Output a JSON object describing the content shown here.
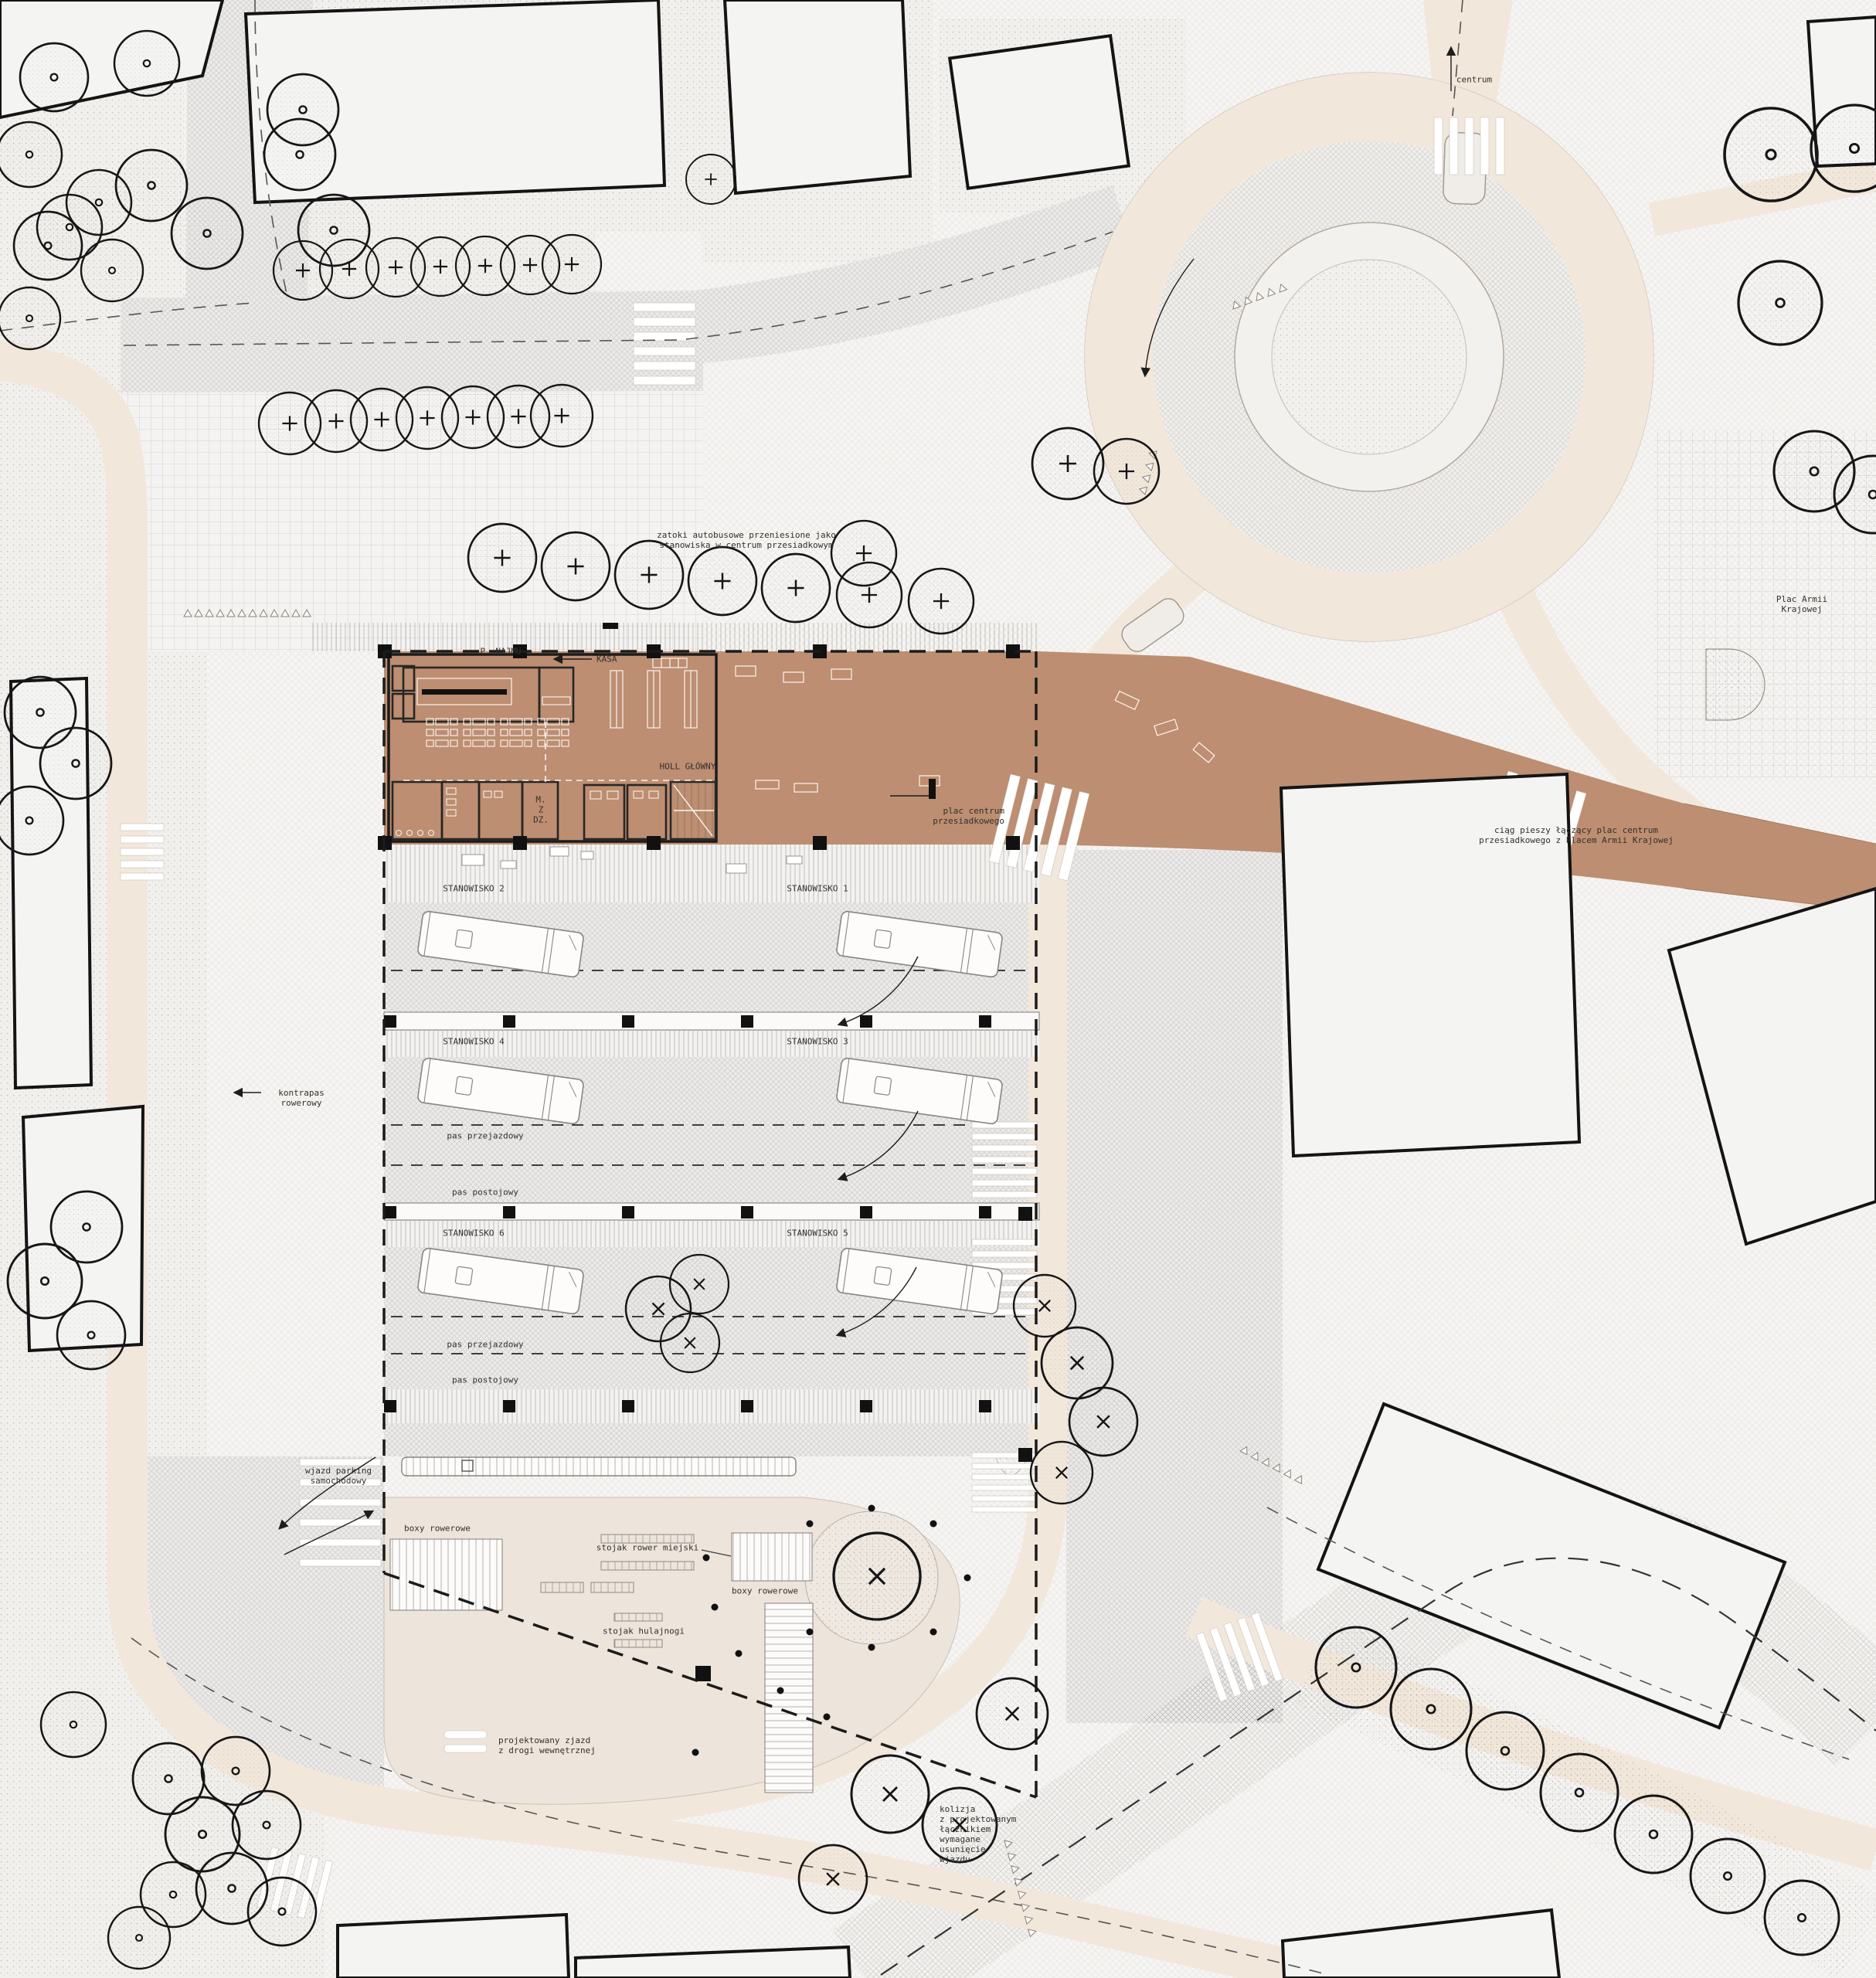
{
  "drawing": {
    "type": "architectural site plan — transit interchange center",
    "language": "Polish",
    "theme_colors": {
      "plaza_brown": "#bd8e71",
      "road_cream": "#f2e7db",
      "paper": "#f6f5f3",
      "ink": "#33302c"
    }
  },
  "labels": {
    "centrum": "centrum",
    "zatoki": "zatoki autobusowe przeniesione jako\nstanowiska w centrum przesiadkowym",
    "plac_armii": "Plac Armii\nKrajowej",
    "p_najmu": "P. NAJMU",
    "kasa": "KASA",
    "holl_glowny": "HOLL GŁÓWNY",
    "m_z_dz": "M.\nZ\nDZ.",
    "plac_centrum": "plac centrum\nprzesiadkowego",
    "ciag_pieszy": "ciąg pieszy łączący plac centrum\nprzesiadkowego z Placem Armii Krajowej",
    "stanowisko_1": "STANOWISKO 1",
    "stanowisko_2": "STANOWISKO 2",
    "stanowisko_3": "STANOWISKO 3",
    "stanowisko_4": "STANOWISKO 4",
    "stanowisko_5": "STANOWISKO 5",
    "stanowisko_6": "STANOWISKO 6",
    "pas_przejazdowy_1": "pas przejazdowy",
    "pas_postojowy_1": "pas postojowy",
    "pas_przejazdowy_2": "pas przejazdowy",
    "pas_postojowy_2": "pas postojowy",
    "kontrapas": "kontrapas\nrowerowy",
    "wjazd_parking": "wjazd parking\nsamochodowy",
    "boxy_rowerowe_1": "boxy rowerowe",
    "stojak_rower": "stojak rower miejski",
    "boxy_rowerowe_2": "boxy rowerowe",
    "stojak_hulajnogi": "stojak hulajnogi",
    "projektowany_zjazd": "projektowany zjazd\nz drogi wewnętrznej",
    "kolizja": "kolizja\nz projektowanym\nłącznikiem\nwymagane\nusunięcie\nwjazdu"
  }
}
